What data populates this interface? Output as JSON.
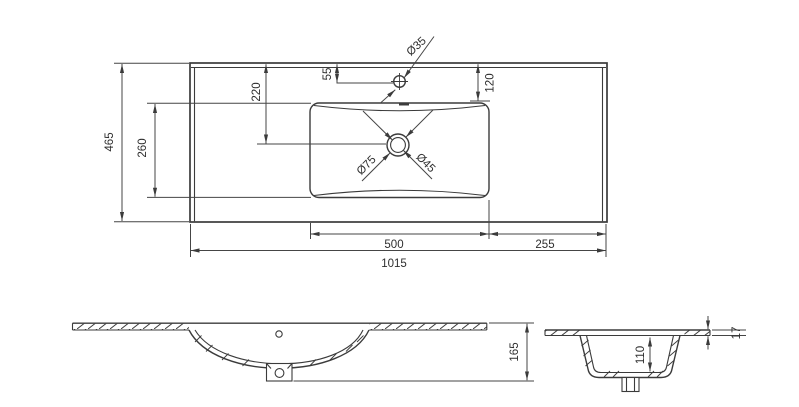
{
  "colors": {
    "line": "#3b3b3b",
    "text": "#2e2e2e",
    "background": "#ffffff"
  },
  "plan_view": {
    "overall_width": "1015",
    "overall_depth": "465",
    "basin_width": "500",
    "right_edge_to_basin": "255",
    "basin_depth": "260",
    "back_to_drain_center": "220",
    "back_to_faucet_center": "55",
    "back_to_basin_edge": "120",
    "faucet_hole_diameter": "Ø35",
    "drain_outer_diameter": "Ø75",
    "drain_inner_diameter": "Ø45"
  },
  "front_section": {
    "overall_height": "165"
  },
  "side_section": {
    "basin_inner_depth": "110",
    "countertop_thickness": "17"
  }
}
